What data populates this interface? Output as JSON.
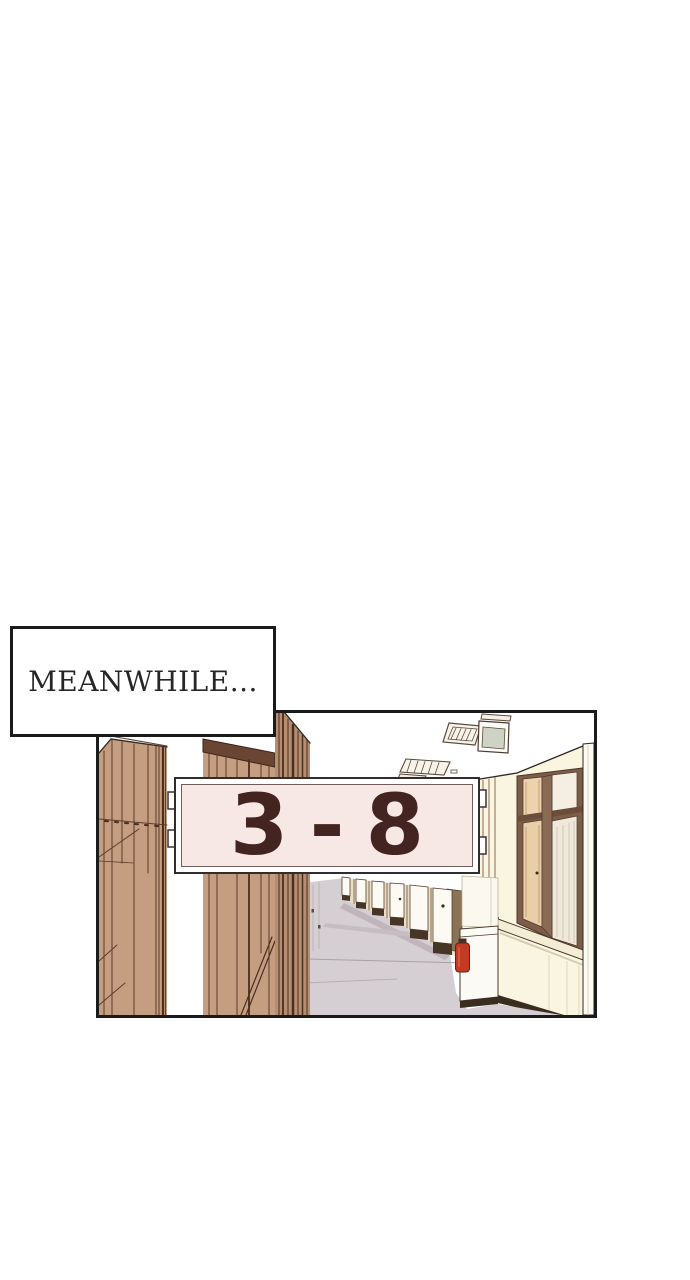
{
  "page": {
    "background_color": "#ffffff"
  },
  "caption_box": {
    "text": "MEANWHILE...",
    "text_color": "#272727",
    "background_color": "#ffffff",
    "border_color": "#1b1b1b"
  },
  "comic_panel": {
    "scene_description": "Empty school hallway in one-point perspective: tan wooden classroom doors on the left, cream wall with brown-framed windows and white pillars on the right, grey floor receding to the distance, ceiling light fixtures and a wall-mounted TV, a red fire extinguisher beside a white cabinet.",
    "border_color": "#1b1b1b",
    "classroom_sign": {
      "text": "3 - 8",
      "text_color": "#442420",
      "plate_color": "#f7e8e5",
      "frame_color": "#ffffff",
      "outline_color": "#332c2c"
    },
    "palette": {
      "door_wood": "#c59d80",
      "door_wood_dark": "#b58e71",
      "wood_line": "#5d3c2a",
      "door_rail_dark": "#6a4534",
      "wall_cream": "#faf5e1",
      "window_frame_brown": "#7d5c48",
      "window_glass_tan": "#ecd3ae",
      "floor_grey": "#d5ced2",
      "floor_shadow": "#bfb5ba",
      "tv_screen_green": "#cdd3c5",
      "fire_extinguisher_red": "#c23b22",
      "outline_black": "#1b1b1b"
    }
  }
}
